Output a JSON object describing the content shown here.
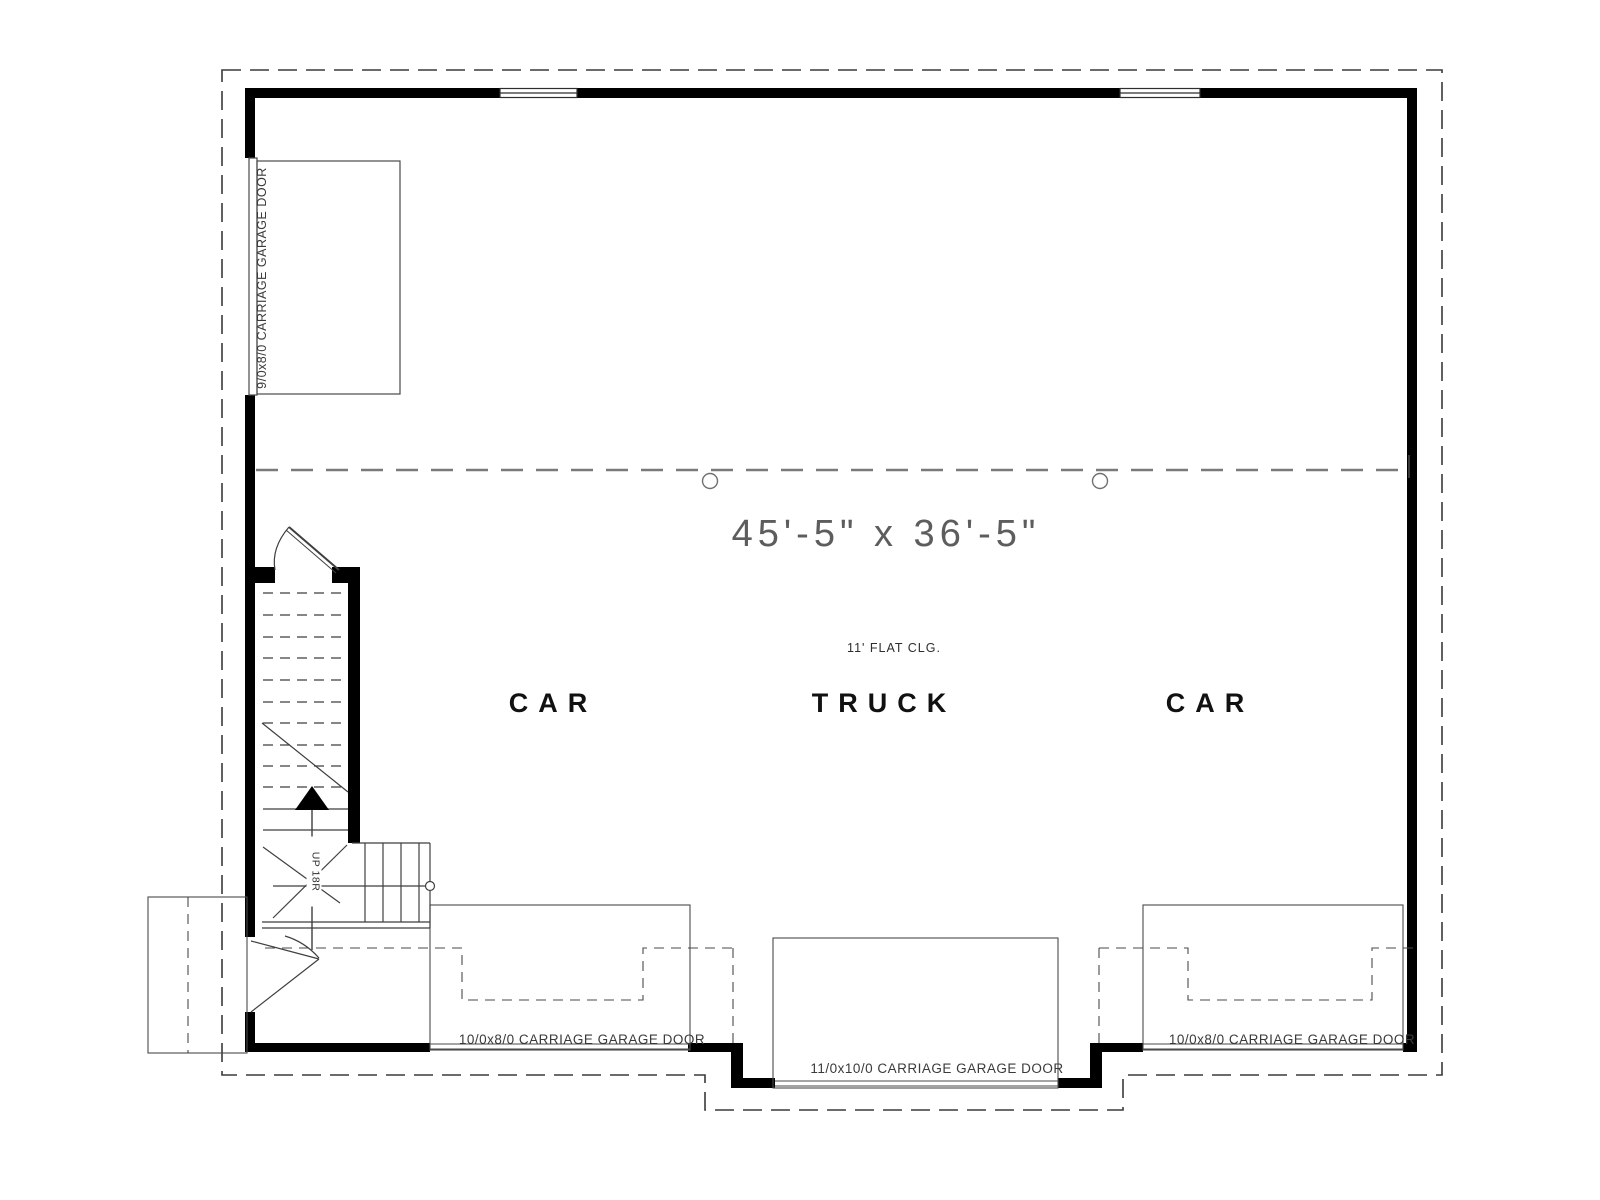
{
  "plan": {
    "room": {
      "dimension_label": "45'-5\" x 36'-5\"",
      "ceiling_label": "11' FLAT CLG.",
      "bays": [
        {
          "label": "CAR"
        },
        {
          "label": "TRUCK"
        },
        {
          "label": "CAR"
        }
      ]
    },
    "doors": {
      "left_wall_garage_door": "9/0x8/0 CARRIAGE GARAGE DOOR",
      "bottom_left_garage_door": "10/0x8/0 CARRIAGE GARAGE DOOR",
      "bottom_center_garage_door": "11/0x10/0 CARRIAGE GARAGE DOOR",
      "bottom_right_garage_door": "10/0x8/0 CARRIAGE GARAGE DOOR"
    },
    "stairs": {
      "direction_label": "UP 18R"
    },
    "colors": {
      "wall": "#000000",
      "thin_line": "#4a4a4a",
      "overhang_dash": "#3a3a3a",
      "ceiling_dash": "#7a7a7a",
      "text": "#3f3f3f"
    }
  }
}
